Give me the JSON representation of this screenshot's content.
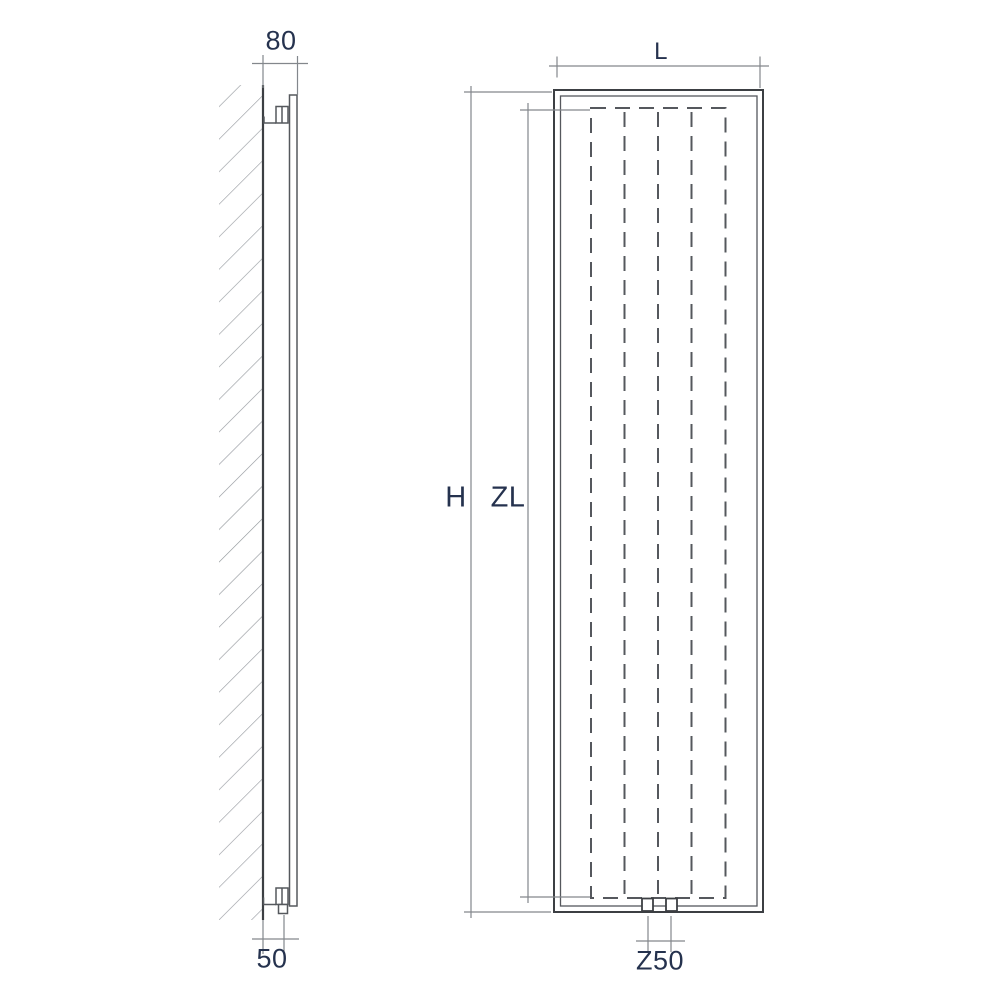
{
  "labels": {
    "depth_top": "80",
    "wall_distance_bottom": "50",
    "height": "H",
    "heated_length": "ZL",
    "length": "L",
    "connection_spacing": "Z50"
  },
  "colors": {
    "line": "#55585d",
    "line_dark": "#3c3f43",
    "dim_line": "#83878c",
    "hatch": "#94989d",
    "label_text": "#25324e",
    "background": "#ffffff"
  }
}
